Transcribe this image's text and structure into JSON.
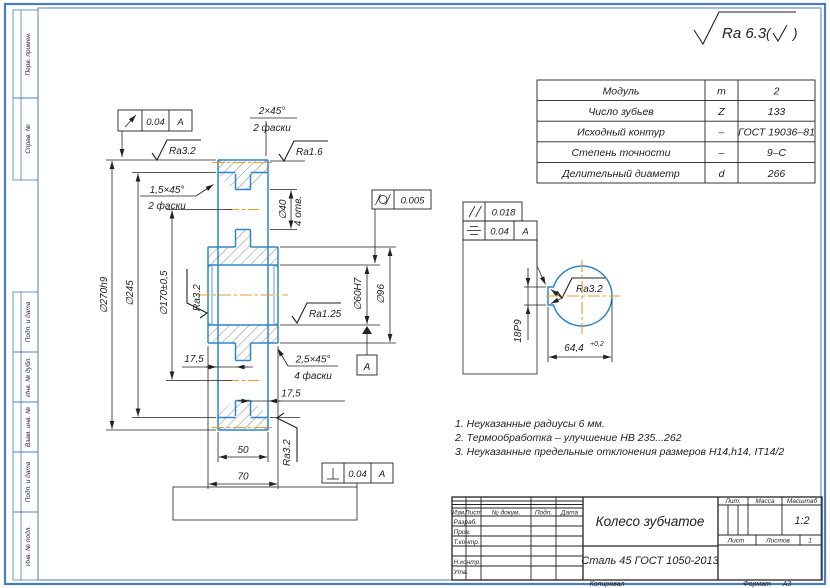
{
  "surface_finish": {
    "general": "Ra 6.3",
    "bracket_open": "(",
    "bracket_close": ")"
  },
  "param_table": {
    "rows": [
      {
        "name": "Модуль",
        "sym": "m",
        "val": "2"
      },
      {
        "name": "Число зубьев",
        "sym": "Z",
        "val": "133"
      },
      {
        "name": "Исходный контур",
        "sym": "–",
        "val": "ГОСТ 19036–81"
      },
      {
        "name": "Степень точности",
        "sym": "–",
        "val": "9–С"
      },
      {
        "name": "Делительный диаметр",
        "sym": "d",
        "val": "266"
      }
    ]
  },
  "dims": {
    "d270": "∅270h9",
    "d245": "∅245",
    "d170": "∅170±0,5",
    "d40": "∅40",
    "d40n": "4 отв.",
    "d60": "∅60H7",
    "d96": "∅96",
    "w50": "50",
    "w70": "70",
    "t175": "17,5",
    "ch2": "2×45°",
    "ch2n": "2 фаски",
    "ch15": "1,5×45°",
    "ch15n": "2 фаски",
    "ch25": "2,5×45°",
    "ch25n": "4 фаски",
    "key18": "18P9",
    "key64": "64,4",
    "key64tol": "+0,2"
  },
  "roughness": {
    "ra32_top": "Ra3.2",
    "ra16": "Ra1.6",
    "ra125": "Ra1.25",
    "ra32_bore": "Ra3.2",
    "ra32_bottom": "Ra3.2",
    "ra32_key": "Ra3.2"
  },
  "tolerances": {
    "runout": "0.04",
    "runout_ref": "A",
    "cyl": "0.005",
    "par": "0.018",
    "sym": "0.04",
    "sym_ref": "A",
    "perp": "0.04",
    "perp_ref": "A",
    "datum": "A"
  },
  "notes": [
    "1. Неуказанные радиусы 6 мм.",
    "2. Термообработка – улучшение НВ 235...262",
    "3. Неуказанные предельные отклонения размеров  H14,h14, IT14/2"
  ],
  "title_block": {
    "col_izm": "Изм.",
    "col_list": "Лист",
    "col_doc": "№ докум.",
    "col_podp": "Подп.",
    "col_data": "Дата",
    "row_razrab": "Разраб.",
    "row_prov": "Пров.",
    "row_tkontr": "Т.контр.",
    "row_nkontr": "Н.контр.",
    "row_utv": "Утв.",
    "title": "Колесо зубчатое",
    "material": "Сталь 45  ГОСТ 1050-2013",
    "lit": "Лит.",
    "mass": "Масса",
    "scale": "Масштаб",
    "scale_val": "1:2",
    "sheet": "Лист",
    "sheets": "Листов",
    "sheets_val": "1",
    "copied": "Копировал",
    "format": "Формат",
    "format_val": "А3"
  },
  "margins": {
    "perv": "Перв. примен.",
    "sprav": "Справ. №",
    "podp1": "Подп. и дата",
    "inv_dubl": "Инв. № дубл.",
    "vzam": "Взам. инв. №",
    "podp2": "Подп. и дата",
    "inv_podl": "Инв. № подл."
  },
  "colors": {
    "object_blue": "#2e86c8",
    "centerline_orange": "#ef9b28",
    "frame_blue": "#4a7dbd",
    "line_black": "#222222"
  }
}
